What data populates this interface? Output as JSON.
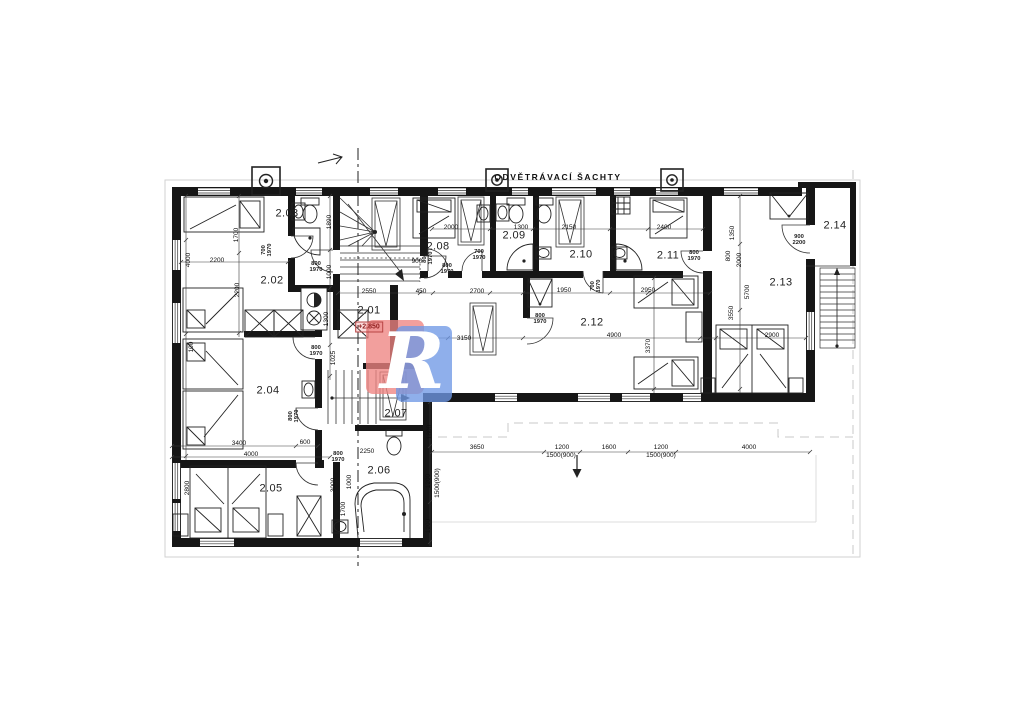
{
  "header": {
    "title": "ODVĚTRÁVACÍ ŠACHTY"
  },
  "elevation": "+2.850",
  "logo": {
    "letter": "R",
    "red": "#ee8482",
    "blue": "#7099e6"
  },
  "rooms": [
    "2.01",
    "2.02",
    "2.03",
    "2.04",
    "2.05",
    "2.06",
    "2.07",
    "2.08",
    "2.09",
    "2.10",
    "2.11",
    "2.12",
    "2.13",
    "2.14"
  ],
  "dims": [
    "2550",
    "450",
    "2700",
    "1950",
    "2950",
    "2000",
    "1300",
    "2150",
    "2400",
    "2200",
    "3400",
    "600",
    "4000",
    "2250",
    "2900",
    "4900",
    "3150",
    "3650",
    "1200",
    "1500(900)",
    "1600",
    "1200",
    "1500(900)",
    "4000",
    "900",
    "1700",
    "4000",
    "2200",
    "100",
    "2800",
    "1890",
    "1000",
    "1300",
    "1025",
    "3000",
    "1000",
    "1700",
    "1800",
    "1200",
    "1500(900)",
    "1200",
    "1350",
    "800",
    "2000",
    "5700",
    "3550",
    "3370"
  ],
  "doors": [
    {
      "w": "800",
      "h": "1970"
    },
    {
      "w": "800",
      "h": "1970"
    },
    {
      "w": "800",
      "h": "1970"
    },
    {
      "w": "700",
      "h": "1970"
    },
    {
      "w": "700",
      "h": "1970"
    },
    {
      "w": "800",
      "h": "1970"
    },
    {
      "w": "800",
      "h": "1970"
    },
    {
      "w": "800",
      "h": "1970"
    },
    {
      "w": "800",
      "h": "1970"
    },
    {
      "w": "700",
      "h": "1970"
    },
    {
      "w": "900",
      "h": "2200"
    },
    {
      "w": "800",
      "h": "1970"
    }
  ],
  "colors": {
    "wall": "#161616",
    "line": "#333333",
    "faint": "#c9c9c9",
    "elevation_red": "#8f1d1d"
  }
}
